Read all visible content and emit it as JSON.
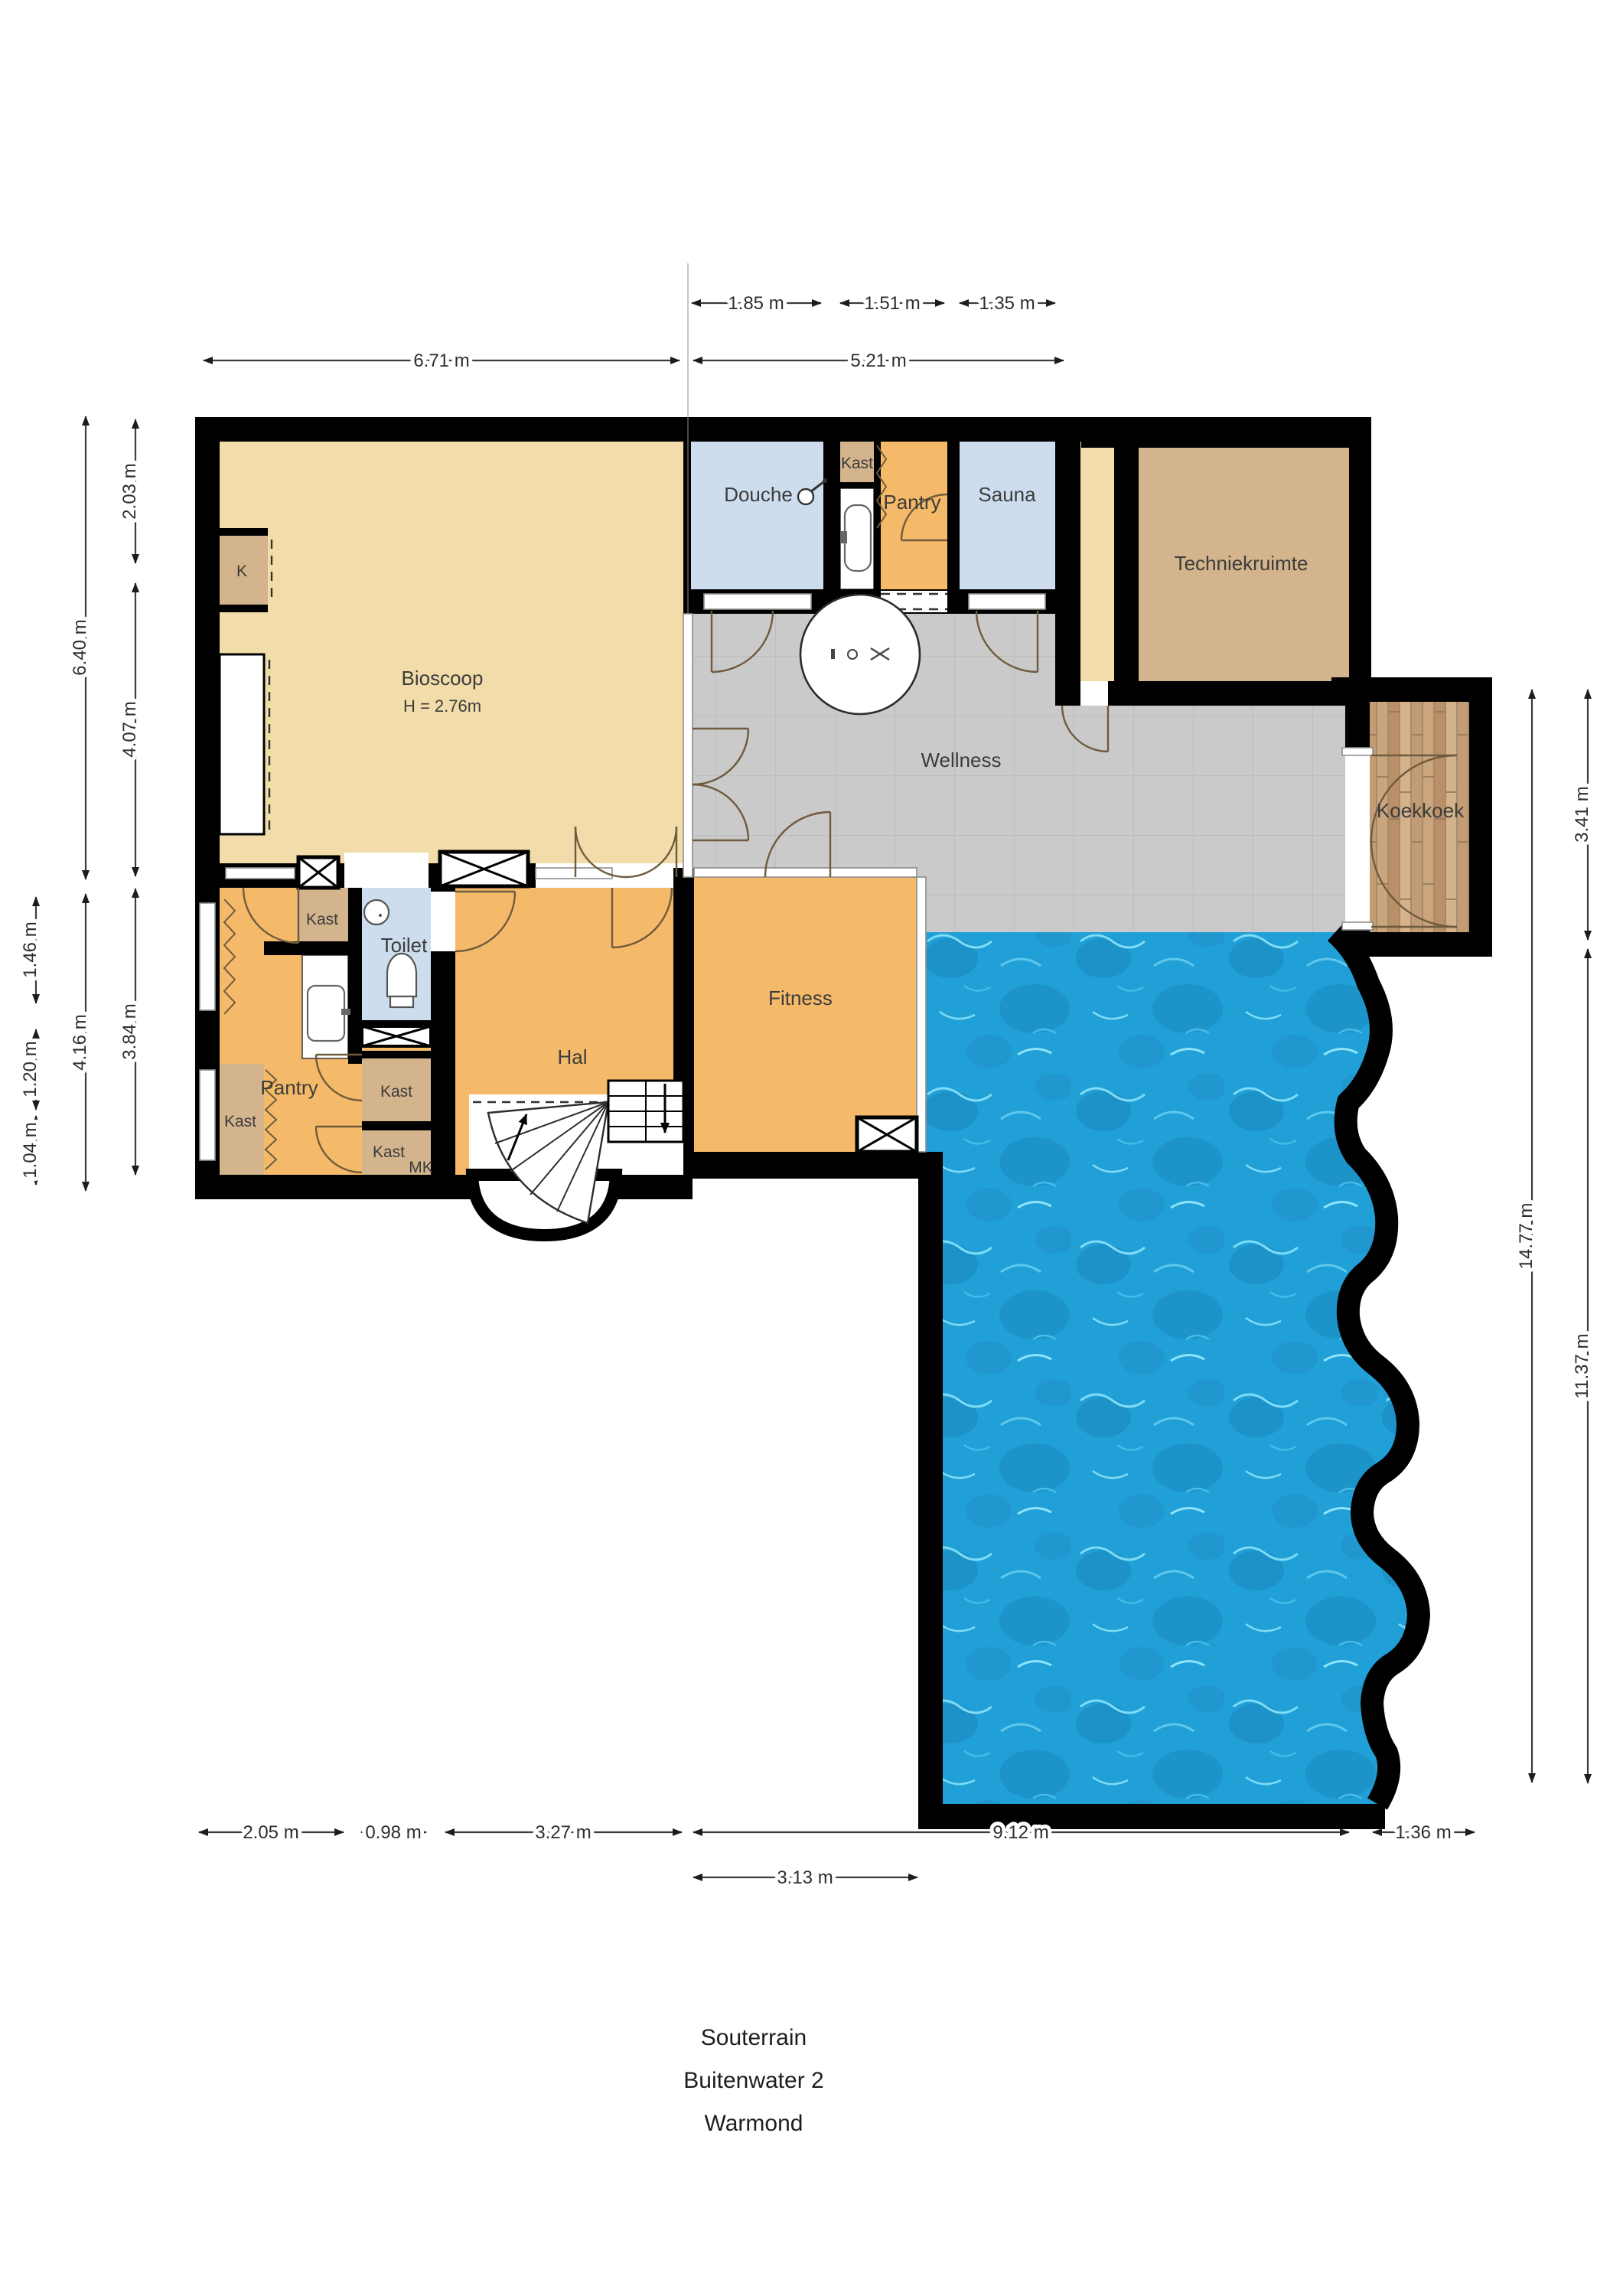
{
  "title": {
    "line1": "Souterrain",
    "line2": "Buitenwater 2",
    "line3": "Warmond"
  },
  "rooms": {
    "bioscoop": {
      "label": "Bioscoop",
      "height_note": "H = 2.76m"
    },
    "k_closet": {
      "label": "K"
    },
    "douche": {
      "label": "Douche"
    },
    "kast_boven": {
      "label": "Kast"
    },
    "pantry_boven": {
      "label": "Pantry"
    },
    "sauna": {
      "label": "Sauna"
    },
    "techniekruimte": {
      "label": "Techniekruimte"
    },
    "wellness": {
      "label": "Wellness"
    },
    "koekkoek": {
      "label": "Koekkoek"
    },
    "toilet": {
      "label": "Toilet"
    },
    "hal": {
      "label": "Hal"
    },
    "fitness": {
      "label": "Fitness"
    },
    "pantry": {
      "label": "Pantry"
    },
    "kast_links": {
      "label": "Kast"
    },
    "kast_kolom_boven": {
      "label": "Kast"
    },
    "kast_midden": {
      "label": "Kast"
    },
    "kast_onder": {
      "label": "Kast"
    },
    "mk": {
      "label": "MK"
    }
  },
  "dimensions": {
    "top_row1": [
      {
        "label": "1.85 m"
      },
      {
        "label": "1.51 m"
      },
      {
        "label": "1.35 m"
      }
    ],
    "top_row2": [
      {
        "label": "6.71 m"
      },
      {
        "label": "5.21 m"
      }
    ],
    "left_inner": [
      {
        "label": "2.03 m"
      },
      {
        "label": "4.07 m"
      },
      {
        "label": "3.84 m"
      }
    ],
    "left_mid": [
      {
        "label": "6.40 m"
      },
      {
        "label": "4.16 m"
      }
    ],
    "left_outer": [
      {
        "label": "1.46 m"
      },
      {
        "label": "1.20 m"
      },
      {
        "label": "1.04 m"
      }
    ],
    "right": [
      {
        "label": "14.77 m"
      },
      {
        "label": "3.41 m"
      },
      {
        "label": "11.37 m"
      }
    ],
    "bottom_row1": [
      {
        "label": "2.05 m"
      },
      {
        "label": "0.98 m"
      },
      {
        "label": "3.27 m"
      },
      {
        "label": "9.12 m"
      },
      {
        "label": "1.36 m"
      }
    ],
    "bottom_row2": [
      {
        "label": "3.13 m"
      }
    ]
  },
  "colors": {
    "wall": "#000000",
    "bioscoop_floor": "#F2DCA9",
    "orange_floor": "#F5BA69",
    "closet_tan": "#D3B48C",
    "wet_room_blue": "#CDDDED",
    "tile_gray": "#CACACA",
    "pool_blue": "#1E9AD2",
    "wood_brown": "#C8A47C"
  }
}
